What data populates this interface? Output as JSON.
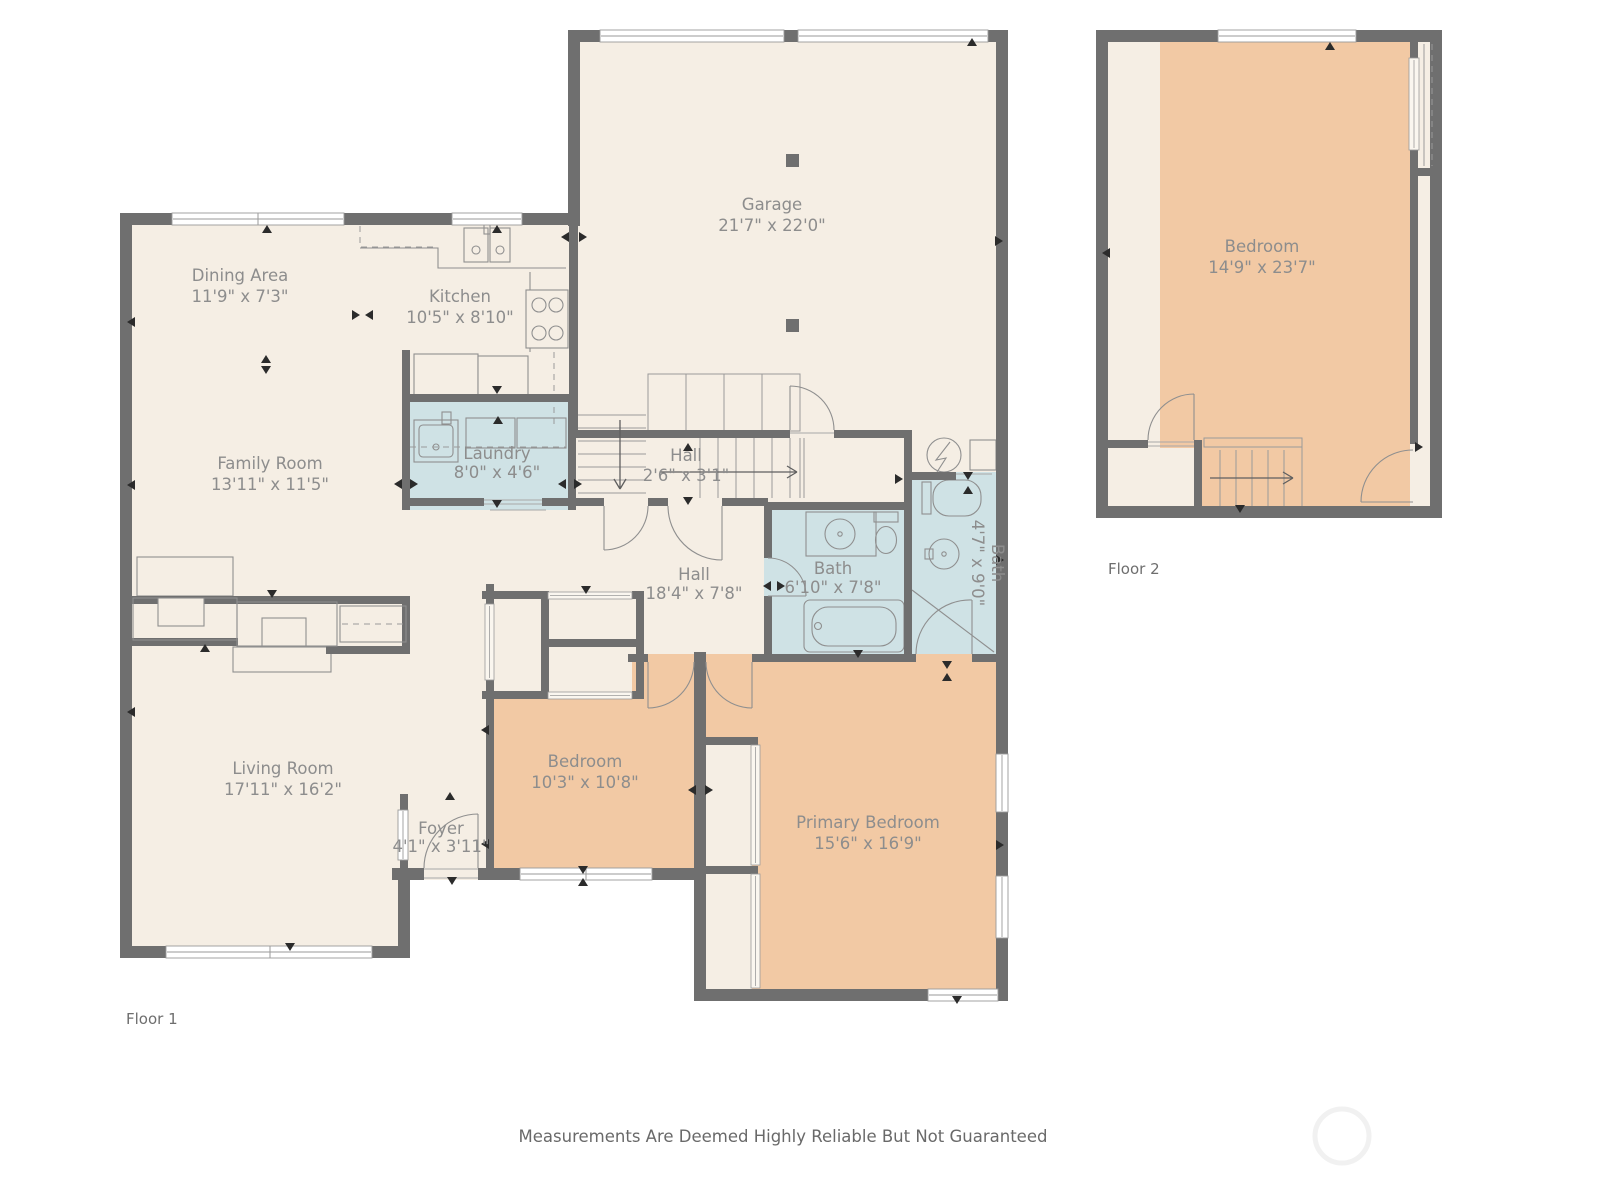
{
  "colors": {
    "wall": "#6f6f6f",
    "floor": "#f5eee4",
    "bedroom_fill": "#f2c9a4",
    "bath_fill": "#cfe2e5",
    "label_text": "#8d8d8d"
  },
  "f1": {
    "garage": {
      "name": "Garage",
      "dims": "21'7\" x 22'0\""
    },
    "dining": {
      "name": "Dining Area",
      "dims": "11'9\" x 7'3\""
    },
    "kitchen": {
      "name": "Kitchen",
      "dims": "10'5\" x 8'10\""
    },
    "family": {
      "name": "Family Room",
      "dims": "13'11\" x 11'5\""
    },
    "laundry": {
      "name": "Laundry",
      "dims": "8'0\" x 4'6\""
    },
    "hall_stairs": {
      "name": "Hall",
      "dims": "2'6\" x 3'1\""
    },
    "hall": {
      "name": "Hall",
      "dims": "18'4\" x 7'8\""
    },
    "bath": {
      "name": "Bath",
      "dims": "6'10\" x 7'8\""
    },
    "bath2": {
      "name": "Bath",
      "dims": "4'7\" x 9'0\""
    },
    "living": {
      "name": "Living Room",
      "dims": "17'11\" x 16'2\""
    },
    "foyer": {
      "name": "Foyer",
      "dims": "4'1\" x 3'11\""
    },
    "bedroom": {
      "name": "Bedroom",
      "dims": "10'3\" x 10'8\""
    },
    "primary": {
      "name": "Primary Bedroom",
      "dims": "15'6\" x 16'9\""
    }
  },
  "f2": {
    "bedroom": {
      "name": "Bedroom",
      "dims": "14'9\" x 23'7\""
    }
  },
  "floor_labels": {
    "f1": "Floor 1",
    "f2": "Floor 2"
  },
  "footer": "Measurements Are Deemed Highly Reliable But Not Guaranteed"
}
